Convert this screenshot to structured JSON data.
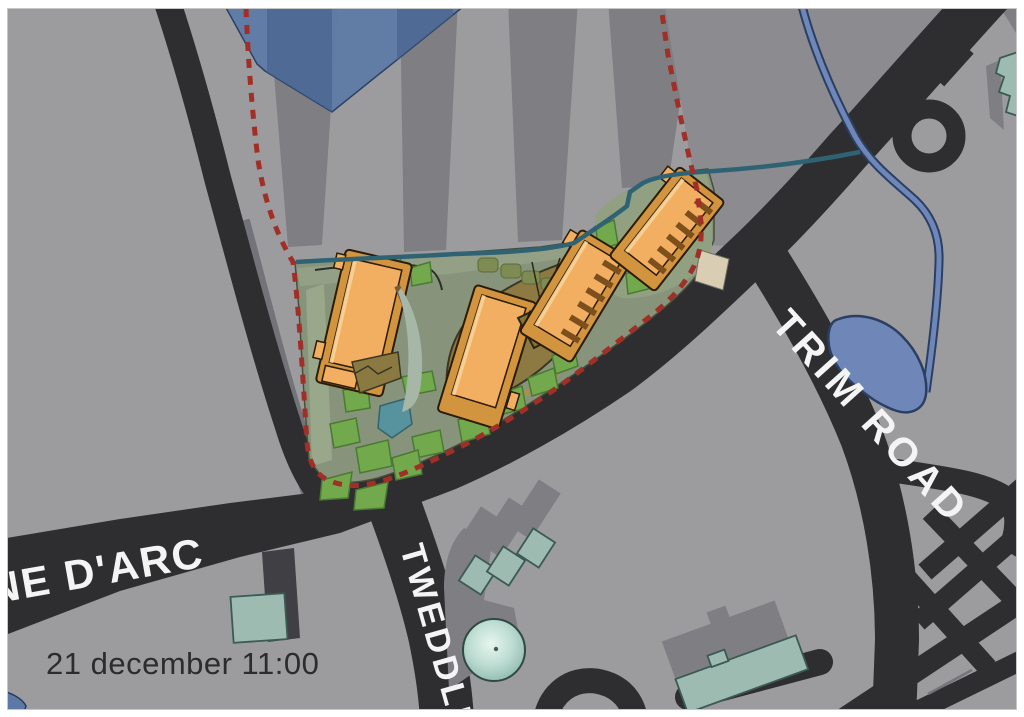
{
  "labels": {
    "timestamp": "21 december 11:00",
    "road_jeanne_darc": "NE D'ARC",
    "road_trim": "TRIM ROAD",
    "road_tweddle": "TWEDDLE"
  },
  "colors": {
    "frame": "#ffffff",
    "bg": "#9c9c9f",
    "shadow": "#7f7f83",
    "shadow2": "#8b8b90",
    "road": "#2e2e30",
    "green": "#87947b",
    "greenLight": "#96a287",
    "lawn": "#72a94c",
    "lawnEdge": "#4a7a33",
    "shrub": "#7e8b52",
    "plaza": "#8c7a42",
    "court": "#8a7a42",
    "orange": "#d2943f",
    "orangeLight": "#f2af62",
    "orangePale": "#f9d39b",
    "rib": "#7c4f1c",
    "teal": "#9dbbb1",
    "tealTower": "#e7f6ef",
    "water": "#6f87b8",
    "waterEdge": "#2b3f63",
    "creek": "#2f6374",
    "blueBldg": "#5d7aa6",
    "blueBldgDark": "#4a6590",
    "boundary": "#a02f27",
    "entrance": "#d9cdb4",
    "sidewalk": "#b1b1b4",
    "labelWhite": "#f4f4f4",
    "textDark": "#2c2c2c"
  }
}
